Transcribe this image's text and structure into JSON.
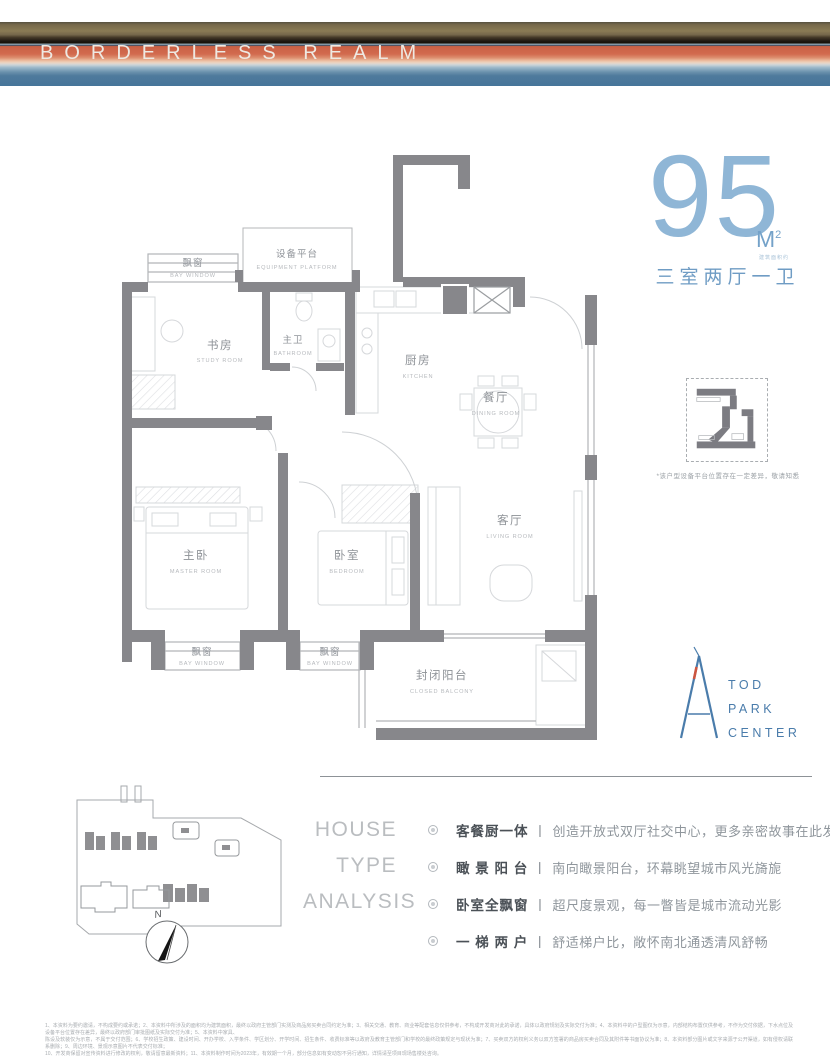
{
  "banner": {
    "title": "BORDERLESS REALM"
  },
  "headline": {
    "area_value": "95",
    "area_unit": "M",
    "area_sup": "2",
    "area_note": "建筑面积约",
    "layout": "三室两厅一卫"
  },
  "floor_plan": {
    "equipment_platform": {
      "cn": "设备平台",
      "en": "EQUIPMENT PLATFORM"
    },
    "bay_window_top": {
      "cn": "飘窗",
      "en": "BAY WINDOW"
    },
    "study": {
      "cn": "书房",
      "en": "STUDY ROOM"
    },
    "master_bath": {
      "cn": "主卫",
      "en": "BATHROOM"
    },
    "kitchen": {
      "cn": "厨房",
      "en": "KITCHEN"
    },
    "dining": {
      "cn": "餐厅",
      "en": "DINING ROOM"
    },
    "master": {
      "cn": "主卧",
      "en": "MASTER ROOM"
    },
    "bedroom": {
      "cn": "卧室",
      "en": "BEDROOM"
    },
    "living": {
      "cn": "客厅",
      "en": "LIVING ROOM"
    },
    "balcony": {
      "cn": "封闭阳台",
      "en": "CLOSED BALCONY"
    },
    "bay_window_left": {
      "cn": "飘窗",
      "en": "BAY WINDOW"
    },
    "bay_window_mid": {
      "cn": "飘窗",
      "en": "BAY WINDOW"
    }
  },
  "detail": {
    "note": "*该户型设备平台位置存在一定差异，敬请知悉"
  },
  "logo": {
    "lines": [
      "TOD",
      "PARK",
      "CENTER"
    ]
  },
  "site_plan": {
    "compass": "N"
  },
  "analysis": {
    "title_lines": [
      "HOUSE",
      "TYPE",
      "ANALYSIS"
    ],
    "separator": "丨",
    "items": [
      {
        "head": "客餐厨一体",
        "desc": "创造开放式双厅社交中心，更多亲密故事在此发生"
      },
      {
        "head": "瞰 景 阳 台",
        "desc": "南向瞰景阳台，环幕眺望城市风光旖旎"
      },
      {
        "head": "卧室全飘窗",
        "desc": "超尺度景观，每一瞥皆是城市流动光影"
      },
      {
        "head": "一 梯 两 户",
        "desc": "舒适梯户比，敞怀南北通透清风舒畅"
      }
    ]
  },
  "disclaimer": {
    "lines": [
      "1、本资料为要约邀请，不构成要约或承诺；2、本资料中所涉及的面积均为建筑面积，最终以政府主管部门实测及商品房买卖合同约定为准；3、相关交通、教育、商业等配套信息仅供参考，不构成开发商对此的承诺，具体以政府规划及实际交付为准；4、本资料中的户型图仅为示意，内部结构布置仅供参考，不作为交付依据，下水点位及设备平台位置存在差异，最终以政府部门审批图纸及实际交付为准；5、本资料中家具、",
      "陈设及软装仅为示意，不属于交付范围；6、学校招生政策、建设时间、开办学校、入学条件、学区划分、开学时间、招生条件、收费标准等以政府及教育主管部门和学校的最终政策规定与现状为准；7、买卖双方的权利义务以双方签署的商品房买卖合同及其附件等书面协议为准；8、本资料部分图片或文字来源于公开渠道，如有侵权请联系删除；9、周边环境、景观示意图片不代表交付标准；",
      "10、开发商保留对宣传资料进行修改的权利，敬请留意最新资料；11、本资料制作时间为2023年，有效期一个月，部分信息如有变动恕不另行通知，详情请至项目现场售楼处咨询。"
    ]
  },
  "colors": {
    "accent_blue": "#6f9cc4",
    "wall_gray": "#87878b",
    "coral": "#d2694e"
  }
}
